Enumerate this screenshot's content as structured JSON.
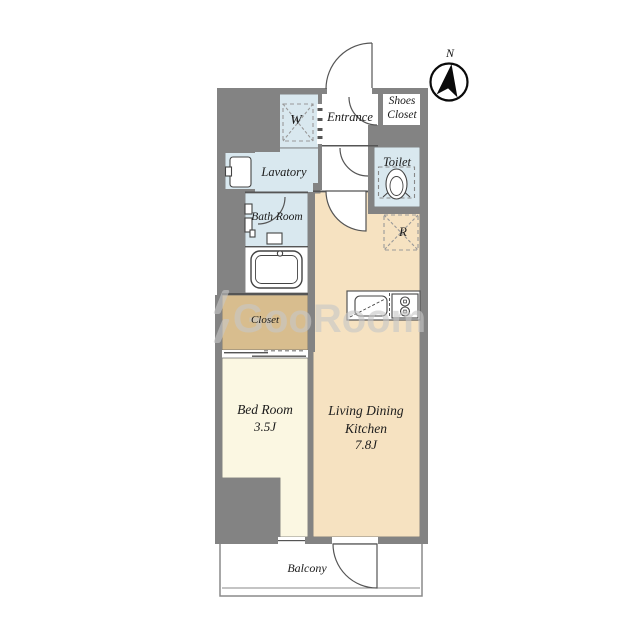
{
  "compass": {
    "north": "N"
  },
  "watermark": {
    "text": "GooRoom"
  },
  "rooms": {
    "entrance": {
      "label": "Entrance"
    },
    "shoes_closet": {
      "label": "Shoes Closet"
    },
    "toilet": {
      "label": "Toilet"
    },
    "lavatory": {
      "label": "Lavatory"
    },
    "bath_room": {
      "label": "Bath Room"
    },
    "washer": {
      "label": "W"
    },
    "refrigerator": {
      "label": "R"
    },
    "closet": {
      "label": "Closet"
    },
    "bed_room": {
      "label": "Bed Room",
      "size": "3.5J"
    },
    "living_dining_kitchen": {
      "label": "Living Dining Kitchen",
      "size": "7.8J"
    },
    "balcony": {
      "label": "Balcony"
    }
  },
  "colors": {
    "wall": "#838383",
    "wet_area_floor": "#d9e8ef",
    "ldk_floor": "#f6e2c1",
    "closet_floor": "#d8bd8e",
    "bedroom_floor": "#fbf7e2",
    "line": "#555555",
    "watermark": "#c7c7c7"
  }
}
